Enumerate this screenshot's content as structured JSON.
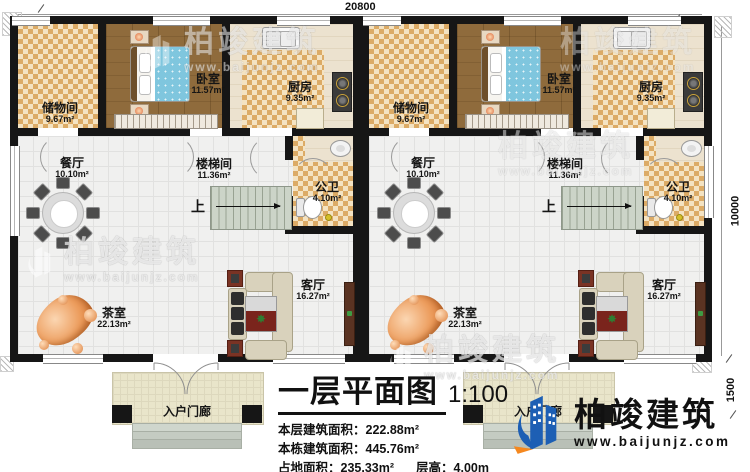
{
  "dims": {
    "width_top": "20800",
    "height_right": "10000",
    "porch_height": "1500"
  },
  "rooms": {
    "storage": {
      "name": "储物间",
      "area": "9.67m²"
    },
    "bedroom": {
      "name": "卧室",
      "area": "11.57m²"
    },
    "kitchen": {
      "name": "厨房",
      "area": "9.35m²"
    },
    "dining": {
      "name": "餐厅",
      "area": "10.10m²"
    },
    "stairwell": {
      "name": "楼梯间",
      "area": "11.36m²"
    },
    "bathroom": {
      "name": "公卫",
      "area": "4.10m²"
    },
    "living": {
      "name": "客厅",
      "area": "16.27m²"
    },
    "tearoom": {
      "name": "茶室",
      "area": "22.13m²"
    },
    "porch": {
      "name": "入户门廊"
    },
    "stairs_up_label": "上"
  },
  "titleblock": {
    "title": "一层平面图",
    "scale": "1:100",
    "line1_label": "本层建筑面积：",
    "line1_value": "222.88m²",
    "line2_label": "本栋建筑面积：",
    "line2_value": "445.76m²",
    "line3_label": "占地面积：",
    "line3_value": "235.33m²",
    "line3b_label": "层高：",
    "line3b_value": "4.00m"
  },
  "watermark": {
    "brand": "柏竣建筑",
    "site": "www.baijunjz.com"
  },
  "logo": {
    "brand": "柏竣建筑",
    "site": "www.baijunjz.com"
  }
}
